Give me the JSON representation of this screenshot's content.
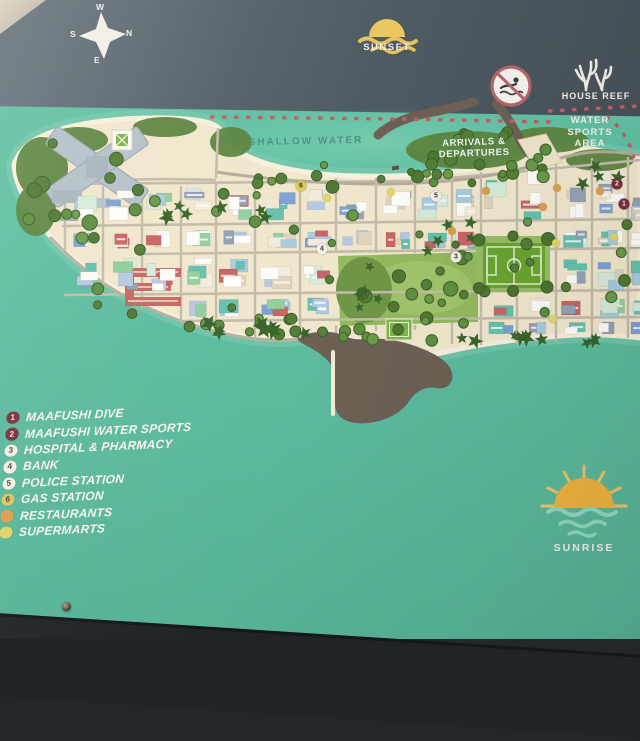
{
  "sign": {
    "compass": {
      "n": "N",
      "s": "S",
      "e": "E",
      "w": "W"
    },
    "sea_labels": {
      "sunset": "SUNSET",
      "sunrise": "SUNRISE",
      "house_reef": "HOUSE REEF",
      "shallow_water": "SHALLOW WATER",
      "arrivals": "ARRIVALS & DEPARTURES",
      "water_sports": [
        "WATER",
        "SPORTS",
        "AREA"
      ]
    },
    "legend": {
      "items": [
        {
          "num": "1",
          "label": "MAAFUSHI DIVE",
          "type": "maroon"
        },
        {
          "num": "2",
          "label": "MAAFUSHI WATER SPORTS",
          "type": "maroon"
        },
        {
          "num": "3",
          "label": "HOSPITAL & PHARMACY",
          "type": "light"
        },
        {
          "num": "4",
          "label": "BANK",
          "type": "light"
        },
        {
          "num": "5",
          "label": "POLICE STATION",
          "type": "light"
        },
        {
          "num": "6",
          "label": "GAS STATION",
          "type": "yellow"
        },
        {
          "num": "",
          "label": "RESTAURANTS",
          "type": "orange"
        },
        {
          "num": "",
          "label": "SUPERMARTS",
          "type": "yellow-dot"
        }
      ]
    },
    "map_markers": [
      {
        "num": "1",
        "type": "maroon",
        "x": 624,
        "y": 204
      },
      {
        "num": "2",
        "type": "maroon",
        "x": 617,
        "y": 184
      },
      {
        "num": "3",
        "type": "light",
        "x": 456,
        "y": 257
      },
      {
        "num": "4",
        "type": "light",
        "x": 322,
        "y": 249
      },
      {
        "num": "5",
        "type": "light",
        "x": 436,
        "y": 196
      },
      {
        "num": "6",
        "type": "yellow",
        "x": 301,
        "y": 186
      }
    ],
    "food_dots": [
      {
        "type": "restaurant",
        "x": 486,
        "y": 191
      },
      {
        "type": "restaurant",
        "x": 557,
        "y": 188
      },
      {
        "type": "restaurant",
        "x": 600,
        "y": 191
      },
      {
        "type": "restaurant",
        "x": 543,
        "y": 207
      },
      {
        "type": "restaurant",
        "x": 452,
        "y": 231
      },
      {
        "type": "supermart",
        "x": 391,
        "y": 192
      },
      {
        "type": "supermart",
        "x": 556,
        "y": 243
      },
      {
        "type": "supermart",
        "x": 614,
        "y": 237
      },
      {
        "type": "supermart",
        "x": 553,
        "y": 319
      },
      {
        "type": "supermart",
        "x": 327,
        "y": 198
      }
    ],
    "colors": {
      "water": "#5fbfa2",
      "deep_water": "#4d5a63",
      "sand": "#f1e7cd",
      "legend_text": "#f6f4ec",
      "marker_maroon": "#7c2f3e",
      "marker_yellow": "#dcca5a",
      "restaurant_dot": "#dd9f4e",
      "supermart_dot": "#e0d66a",
      "dotted_line": "#c05f68"
    }
  }
}
